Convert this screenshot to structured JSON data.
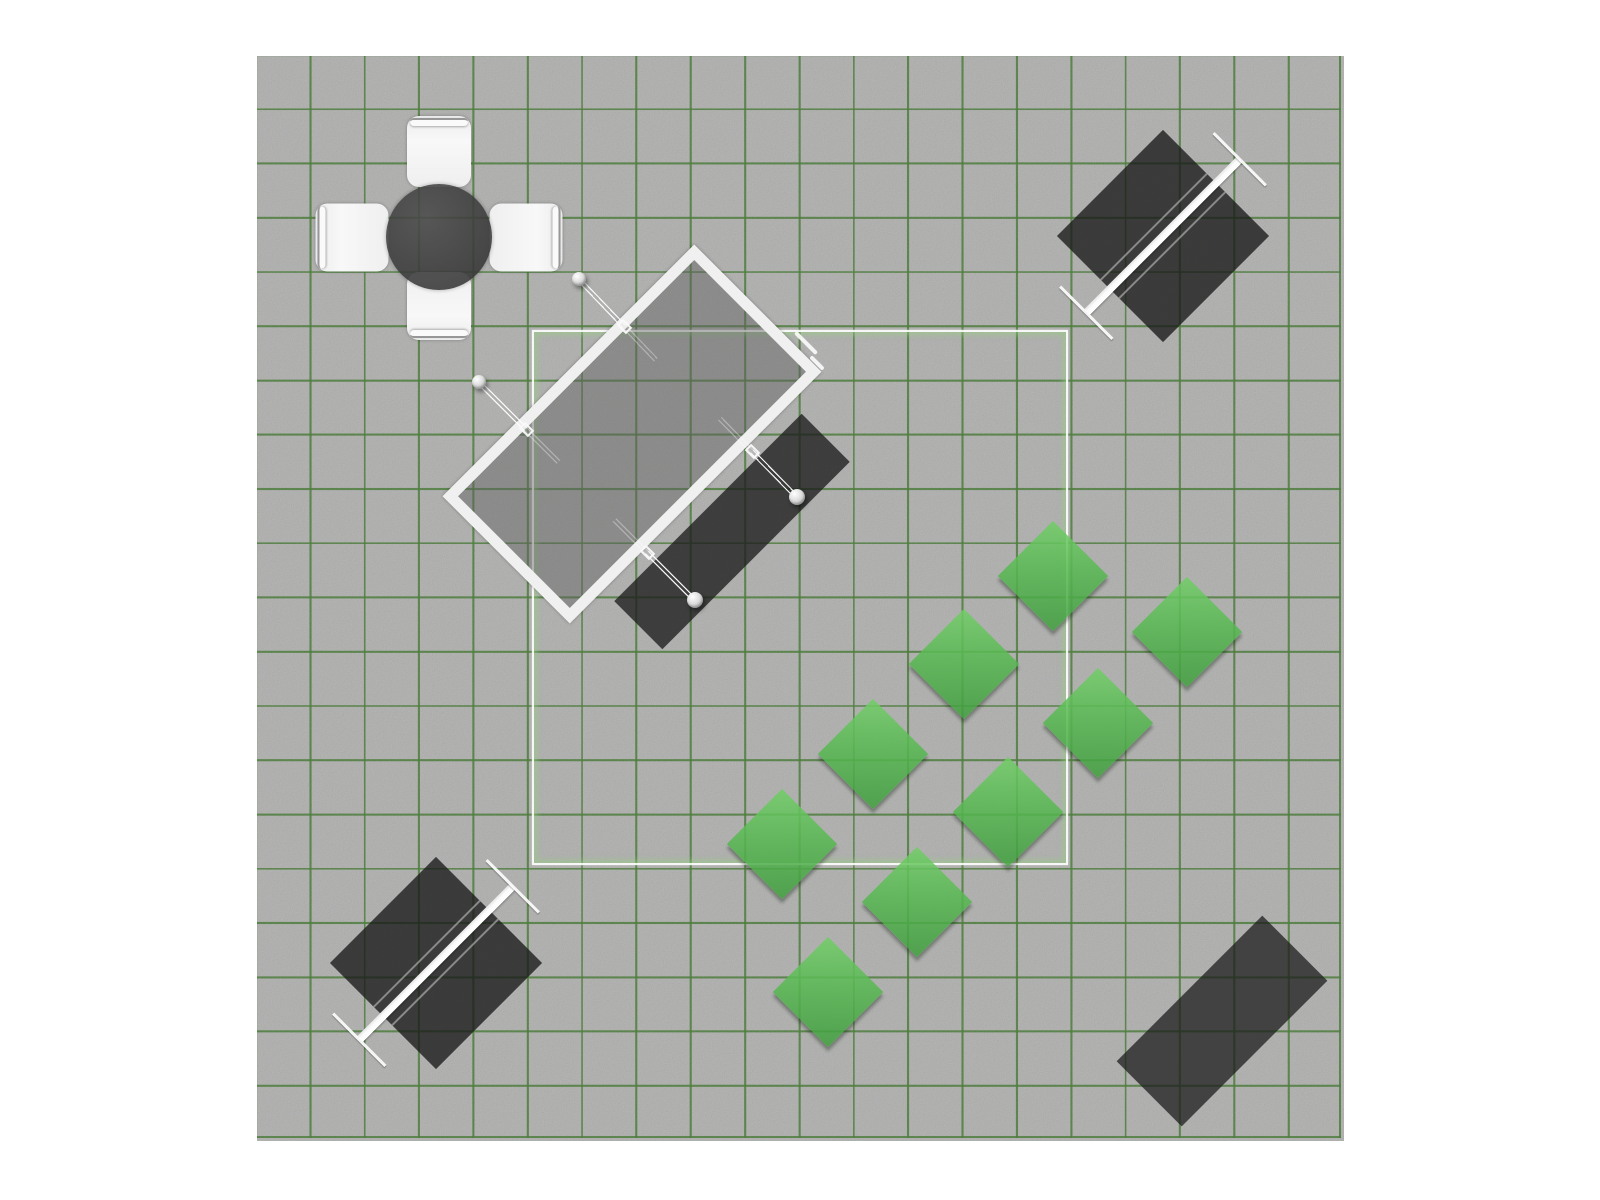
{
  "scene": {
    "canvas": {
      "left": 257,
      "top": 56,
      "width": 1087,
      "height": 1085,
      "background": "#adadac",
      "grid": {
        "columns": 20,
        "rows": 20,
        "color": "rgba(55,112,35,0.85)",
        "line_px": 2
      }
    },
    "region_outline": {
      "left": 532,
      "top": 330,
      "width": 536,
      "height": 535,
      "line_color": "rgba(255,255,255,0.9)",
      "glow_color": "rgba(150,208,128,0.55)"
    },
    "palette": {
      "canvas_gray": "#adadac",
      "grid_green": "#377023",
      "shrub_green": "#57b951",
      "dark_object": "#3a3a3a",
      "furniture_white": "#f2f2f2"
    },
    "objects": [
      {
        "type": "dining-set",
        "name": "round-table-set",
        "table": {
          "cx": 439,
          "cy": 237,
          "diameter": 106
        },
        "chairs": [
          {
            "cx": 439,
            "cy": 151,
            "w": 64,
            "h": 71,
            "rot": 0
          },
          {
            "cx": 526,
            "cy": 237,
            "w": 68,
            "h": 73,
            "rot": 90
          },
          {
            "cx": 439,
            "cy": 306,
            "w": 64,
            "h": 68,
            "rot": 180
          },
          {
            "cx": 352,
            "cy": 237,
            "w": 68,
            "h": 73,
            "rot": 270
          }
        ]
      },
      {
        "type": "swing-set",
        "name": "swing-set",
        "mat": {
          "cx": 732,
          "cy": 531,
          "w": 68,
          "h": 265,
          "rot": 45,
          "color": "rgba(30,30,30,0.79)"
        },
        "frame": {
          "cx": 632,
          "cy": 434,
          "w": 180,
          "h": 356,
          "rot": 45
        },
        "ropes": [
          {
            "x1": 624,
            "y1": 326,
            "x2": 579,
            "y2": 279,
            "ball": 14
          },
          {
            "x1": 526,
            "y1": 429,
            "x2": 479,
            "y2": 382,
            "ball": 14
          },
          {
            "x1": 752,
            "y1": 451,
            "x2": 797,
            "y2": 497,
            "ball": 16
          },
          {
            "x1": 647,
            "y1": 552,
            "x2": 695,
            "y2": 600,
            "ball": 16
          }
        ],
        "dashes": [
          {
            "cx": 806,
            "cy": 343,
            "len": 30
          },
          {
            "cx": 817,
            "cy": 363,
            "len": 18
          }
        ]
      },
      {
        "type": "picnic-table",
        "name": "picnic-table-northeast",
        "cx": 1163,
        "cy": 236,
        "size": 150,
        "rot": 45
      },
      {
        "type": "picnic-table",
        "name": "picnic-table-southwest",
        "cx": 436,
        "cy": 963,
        "size": 150,
        "rot": 45
      },
      {
        "type": "ground-mat",
        "name": "ground-mat-southeast",
        "cx": 1222,
        "cy": 1021,
        "w": 92,
        "h": 206,
        "rot": 45,
        "color": "rgba(30,30,30,0.75)"
      },
      {
        "type": "shrub",
        "cx": 1053,
        "cy": 576,
        "size": 78
      },
      {
        "type": "shrub",
        "cx": 1187,
        "cy": 632,
        "size": 78
      },
      {
        "type": "shrub",
        "cx": 964,
        "cy": 664,
        "size": 78
      },
      {
        "type": "shrub",
        "cx": 1098,
        "cy": 723,
        "size": 78
      },
      {
        "type": "shrub",
        "cx": 873,
        "cy": 754,
        "size": 78
      },
      {
        "type": "shrub",
        "cx": 1008,
        "cy": 812,
        "size": 78
      },
      {
        "type": "shrub",
        "cx": 782,
        "cy": 844,
        "size": 78
      },
      {
        "type": "shrub",
        "cx": 917,
        "cy": 902,
        "size": 78
      },
      {
        "type": "shrub",
        "cx": 828,
        "cy": 992,
        "size": 78
      }
    ]
  }
}
